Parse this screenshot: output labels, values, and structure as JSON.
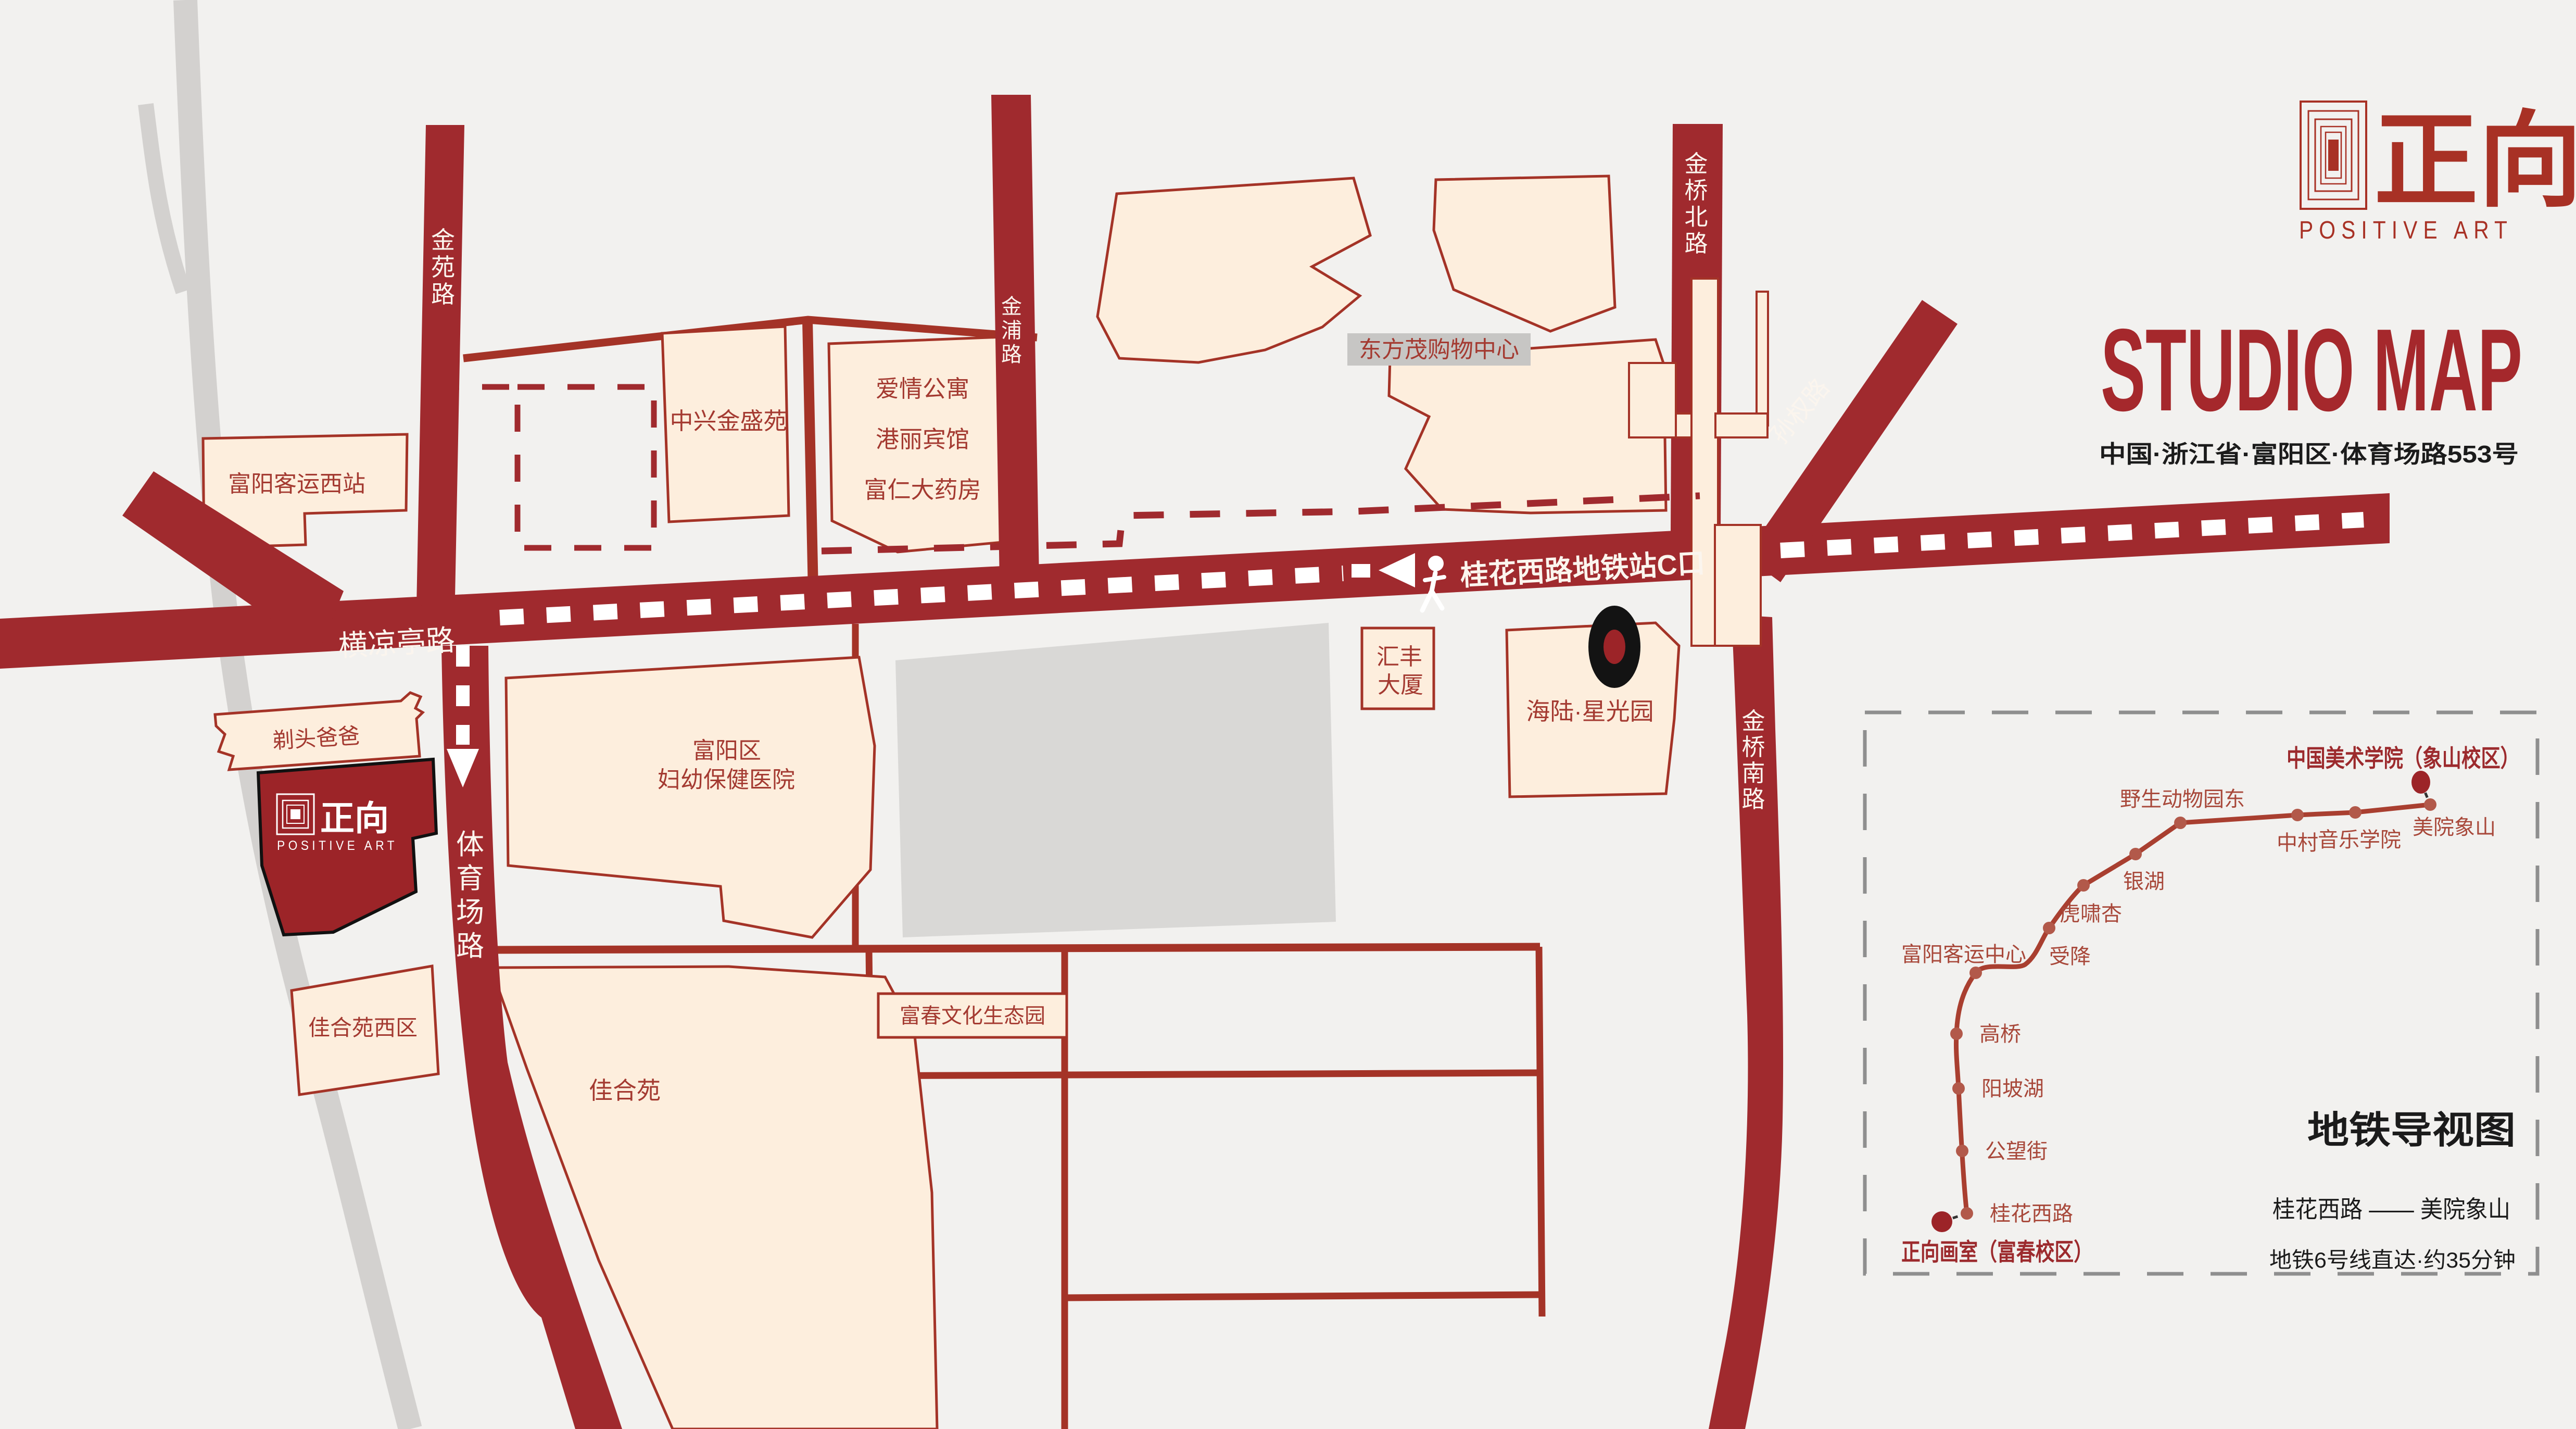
{
  "header": {
    "logo_zh": "正向",
    "logo_en": "POSITIVE ART",
    "title": "STUDIO MAP",
    "address": "中国·浙江省·富阳区·体育场路553号"
  },
  "map": {
    "roads": {
      "jinyuan": "金苑路",
      "jinpu": "金浦路",
      "jinqiao_north": "金桥北路",
      "jinqiao_south": "金桥南路",
      "sunquan": "孙权路",
      "hengliangting": "横凉亭路",
      "tiyuchang": "体育场路",
      "metro_exit": "桂花西路地铁站C口"
    },
    "buildings": {
      "fuyang_west_bus_station": "富阳客运西站",
      "zhongxing_jinsheng": "中兴金盛苑",
      "aiqing_apartment": "爱情公寓",
      "gangli_hotel": "港丽宾馆",
      "furen_pharmacy": "富仁大药房",
      "dongfangmao_mall": "东方茂购物中心",
      "huifeng": [
        "汇丰",
        "大厦"
      ],
      "hailu_starlight": "海陆·星光园",
      "titou_baba": "剃头爸爸",
      "fuyang_maternity": [
        "富阳区",
        "妇幼保健医院"
      ],
      "jiaheyuan_west": "佳合苑西区",
      "jiaheyuan": "佳合苑",
      "fuchun_park": "富春文化生态园"
    },
    "studio": {
      "zh": "正向",
      "en": "POSITIVE ART"
    }
  },
  "metro": {
    "box_title": "地铁导视图",
    "route": "桂花西路 —— 美院象山",
    "note": "地铁6号线直达·约35分钟",
    "terminal_top": "中国美术学院（象山校区）",
    "terminal_bottom": "正向画室（富春校区）",
    "stations": [
      "桂花西路",
      "公望街",
      "阳坡湖",
      "高桥",
      "富阳客运中心",
      "受降",
      "虎啸杏",
      "银湖",
      "野生动物园东",
      "中村",
      "音乐学院",
      "美院象山"
    ]
  },
  "colors": {
    "background": "#f2f1ef",
    "road": "#a02a2e",
    "building_fill": "#fdeedd",
    "building_stroke": "#a43327",
    "building_text": "#a43a31",
    "studio_fill": "#9c2428",
    "accent_red": "#a42a28",
    "gray_block": "#d9d8d6",
    "river": "#d3d1cf",
    "black": "#1b1b1b"
  }
}
